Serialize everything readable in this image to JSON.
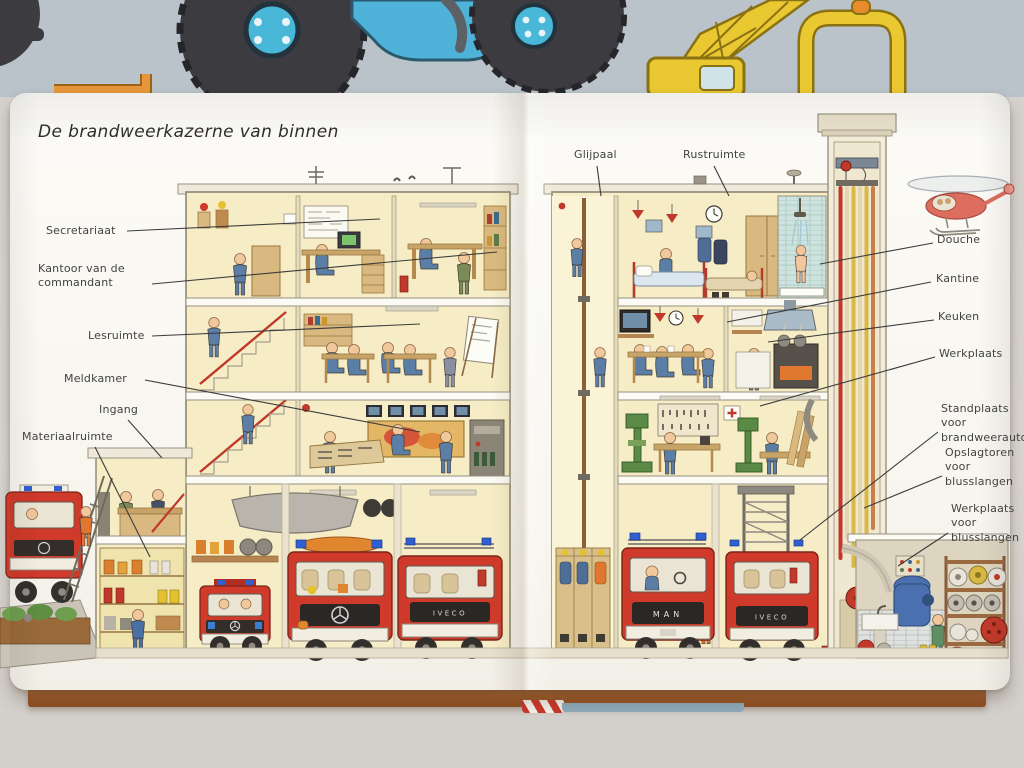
{
  "book": {
    "title": "De brandweerkazerne van binnen",
    "callouts": [
      {
        "id": "secretariaat",
        "label": "Secretariaat"
      },
      {
        "id": "kantoor-van-de-commandant",
        "label": "Kantoor van de commandant"
      },
      {
        "id": "lesruimte",
        "label": "Lesruimte"
      },
      {
        "id": "meldkamer",
        "label": "Meldkamer"
      },
      {
        "id": "ingang",
        "label": "Ingang"
      },
      {
        "id": "materiaalruimte",
        "label": "Materiaalruimte"
      },
      {
        "id": "glijpaal",
        "label": "Glijpaal"
      },
      {
        "id": "rustruimte",
        "label": "Rustruimte"
      },
      {
        "id": "douche",
        "label": "Douche"
      },
      {
        "id": "kantine",
        "label": "Kantine"
      },
      {
        "id": "keuken",
        "label": "Keuken"
      },
      {
        "id": "werkplaats",
        "label": "Werkplaats"
      },
      {
        "id": "standplaats-voor-brandweerautos",
        "label": "Standplaats voor brandweerauto's"
      },
      {
        "id": "opslagtoren-voor-blusslangen",
        "label": "Opslagtoren voor blusslangen"
      },
      {
        "id": "werkplaats-voor-blusslangen",
        "label": "Werkplaats voor blusslangen"
      }
    ],
    "vehicle_badges": {
      "man": "MAN",
      "iveco": "IVECO"
    },
    "colors": {
      "fire_engine_red": "#cf3a2a",
      "room_wall_yellow": "#f6edc6",
      "backdrop_page_blue": "#b9c3c9",
      "crane_yellow": "#e9c832",
      "tractor_blue": "#4fb3d9",
      "hose_red": "#c0392b",
      "hose_yellow": "#d9b945",
      "table_surface": "#d8d4cf",
      "board_edge_brown": "#a8622e"
    }
  }
}
